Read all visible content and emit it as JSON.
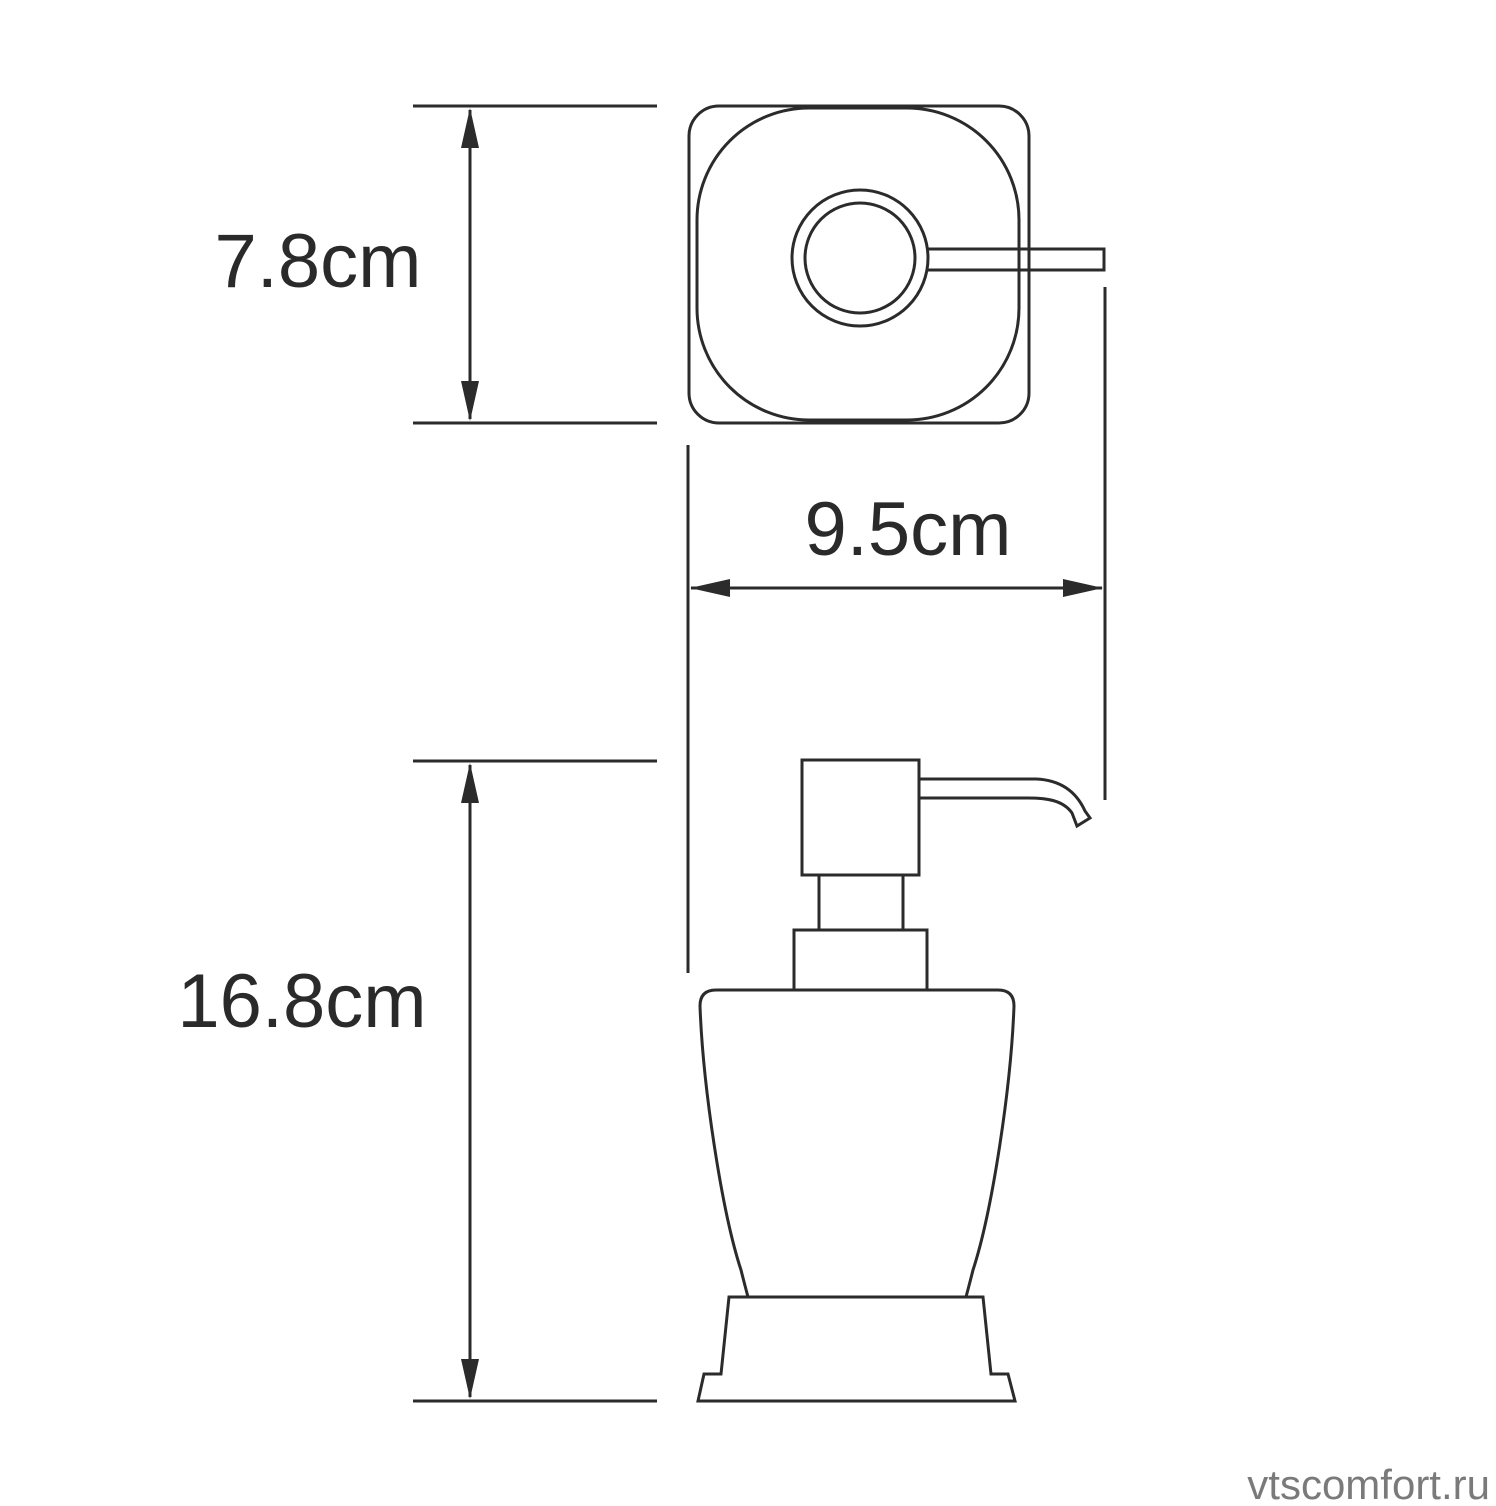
{
  "page": {
    "background": "#ffffff",
    "line_color": "#2b2b2b",
    "label_color": "#2a2a2a",
    "watermark_color": "#7a7a7a"
  },
  "drawing": {
    "kind": "technical dimension drawing",
    "subject": "soap dispenser with pump",
    "views": [
      {
        "id": "top-view"
      },
      {
        "id": "front-view"
      }
    ],
    "dimensions": [
      {
        "id": "top-view-depth",
        "label": "7.8cm",
        "value_cm": 7.8,
        "orientation": "vertical"
      },
      {
        "id": "overall-width",
        "label": "9.5cm",
        "value_cm": 9.5,
        "orientation": "horizontal"
      },
      {
        "id": "overall-height",
        "label": "16.8cm",
        "value_cm": 16.8,
        "orientation": "vertical"
      }
    ],
    "watermark": "vtscomfort.ru"
  }
}
